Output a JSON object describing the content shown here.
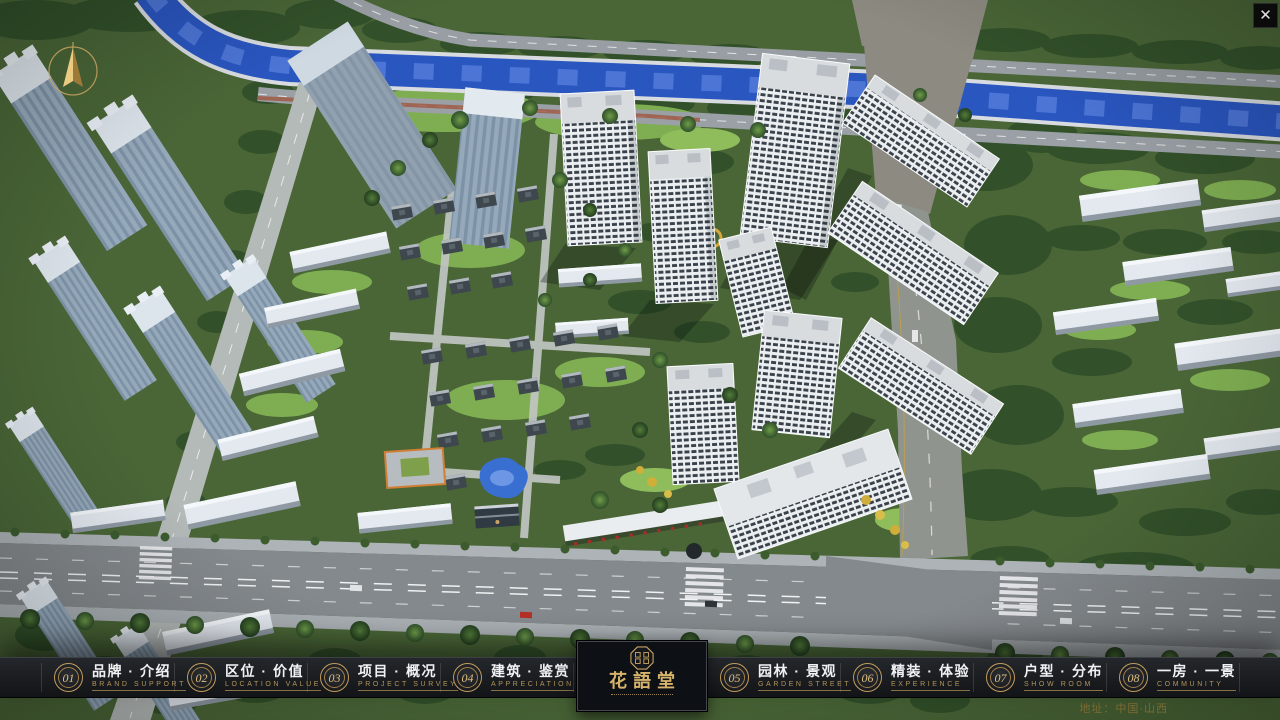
{
  "window": {
    "close_icon": "✕"
  },
  "logo": {
    "title": "花語堂"
  },
  "footer": {
    "address": "地址：中国·山西"
  },
  "menu": {
    "items": [
      {
        "num": "01",
        "zh": "品牌 · 介绍",
        "en": "BRAND SUPPORT"
      },
      {
        "num": "02",
        "zh": "区位 · 价值",
        "en": "LOCATION VALUE"
      },
      {
        "num": "03",
        "zh": "项目 · 概况",
        "en": "PROJECT SURVEY"
      },
      {
        "num": "04",
        "zh": "建筑 · 鉴赏",
        "en": "APPRECIATION"
      },
      {
        "num": "05",
        "zh": "园林 · 景观",
        "en": "GARDEN STREET"
      },
      {
        "num": "06",
        "zh": "精装 · 体验",
        "en": "EXPERIENCE"
      },
      {
        "num": "07",
        "zh": "户型 · 分布",
        "en": "SHOW ROOM"
      },
      {
        "num": "08",
        "zh": "一房 · 一景",
        "en": "COMMUNITY"
      }
    ]
  },
  "colors": {
    "gold": "#c9a362",
    "menu_bg": "#17191c",
    "river_blue": "#2a56c0",
    "accent_red": "#a62c26"
  }
}
